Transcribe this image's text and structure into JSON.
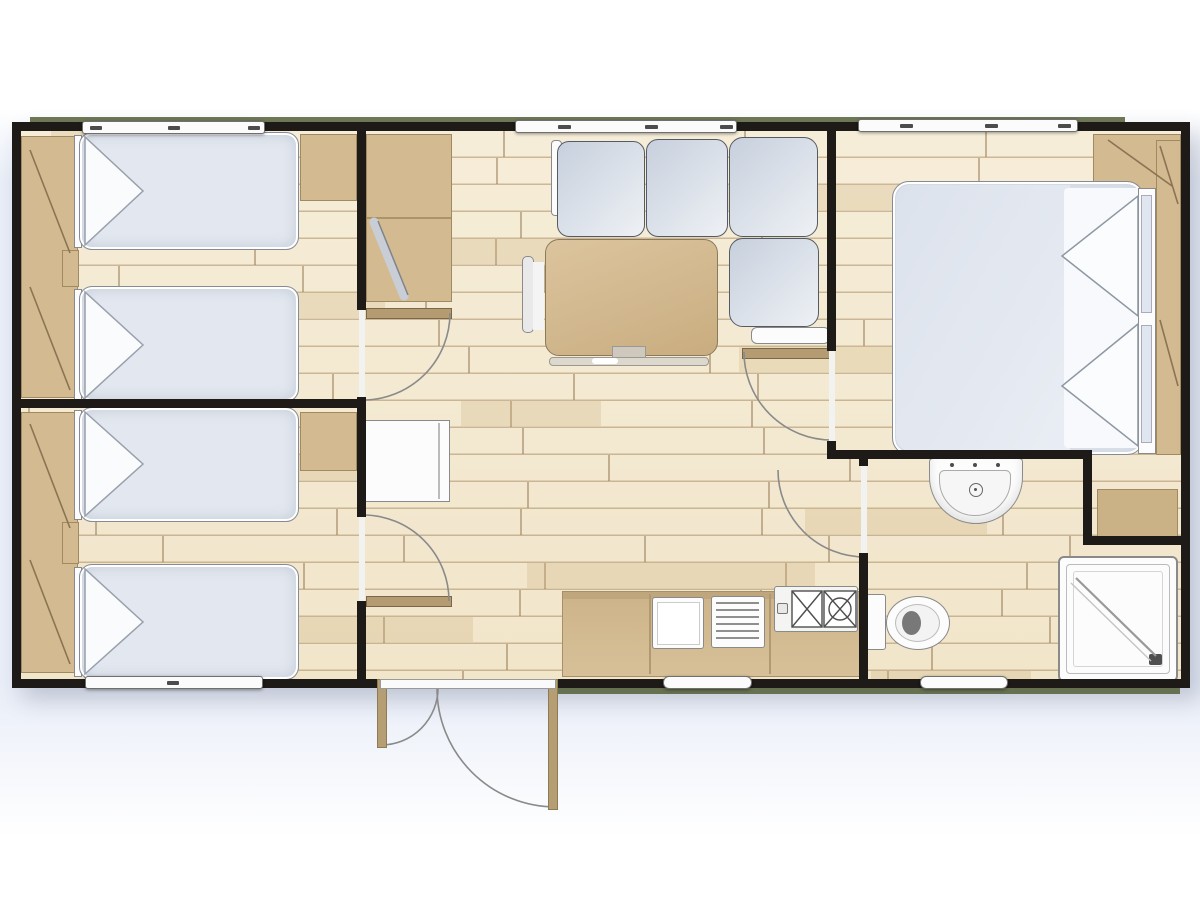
{
  "diagram": {
    "type": "floor-plan",
    "subject": "mobile-home holiday bungalow, top-down view",
    "style": "illustrated plan with wood-plank flooring, black walls, beige furniture, grey-blue upholstery"
  },
  "rooms": [
    {
      "name": "bedroom-twin-top-left",
      "furniture": [
        "left-wardrobe-with-open-doors",
        "single-bed-upper",
        "single-bed-lower",
        "between-beds-shelf",
        "corner-cabinet"
      ]
    },
    {
      "name": "bedroom-twin-bottom-left",
      "furniture": [
        "left-wardrobe-with-open-doors",
        "single-bed-upper",
        "single-bed-lower",
        "between-beds-shelf",
        "corner-cabinet"
      ]
    },
    {
      "name": "entry-hallway",
      "furniture": [
        "tall-cabinet",
        "leaning-board",
        "refrigerator",
        "entry-door-double-swing"
      ]
    },
    {
      "name": "living-dining",
      "furniture": [
        "l-shaped-sofa-4-cushions",
        "sofa-armrest",
        "pedestal-dining-table",
        "chair"
      ]
    },
    {
      "name": "kitchen",
      "furniture": [
        "counter-run",
        "kitchen-sink",
        "drainer-rack",
        "hob-2-burner"
      ]
    },
    {
      "name": "bedroom-double-right",
      "furniture": [
        "double-bed",
        "two-pillows",
        "headboard-shelf",
        "right-wardrobe-with-open-doors",
        "corner-shelf",
        "niche-cabinet"
      ]
    },
    {
      "name": "bathroom",
      "furniture": [
        "washbasin",
        "toilet",
        "shower-cabin"
      ]
    }
  ],
  "openings": {
    "windows_top_wall": 3,
    "windows_bottom_wall": 3,
    "interior_doors_with_swing_arcs": 4,
    "entry_doors": 1
  },
  "counts": {
    "single_beds": 4,
    "double_beds": 1,
    "wardrobes": 3,
    "door_arcs": 6
  },
  "colors": {
    "wall": "#1d1a17",
    "floor": "#f4ead3",
    "floorline": "#a98c63",
    "wood": "#d3ba90",
    "woodDark": "#c7ab7e",
    "woodEdge": "#a08a61",
    "mattress": "#e3e8f0",
    "blanket": "#dee4ee",
    "leaf": "#b49b72",
    "white": "#fcfcfc",
    "outline": "#7c7c7c",
    "green": "#556038",
    "bg": "#e9eef8"
  }
}
